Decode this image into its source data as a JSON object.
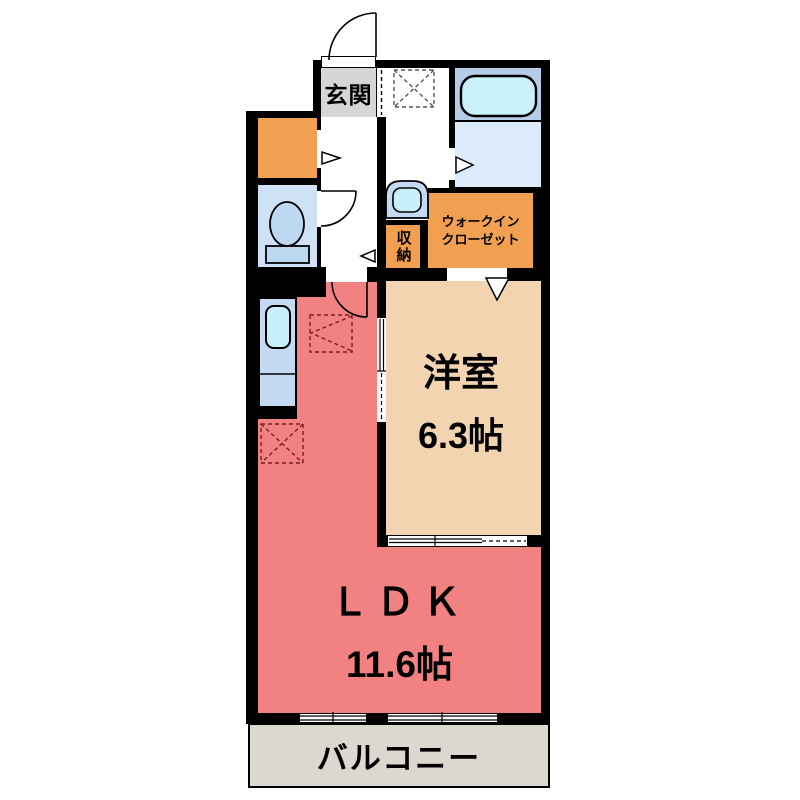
{
  "plan_title": "1LDK apartment floor plan",
  "rooms": {
    "genkan": {
      "label": "玄関"
    },
    "shuno": {
      "label": "収納"
    },
    "wic": {
      "label_line1": "ウォークイン",
      "label_line2": "クローゼット"
    },
    "yoshitsu": {
      "label": "洋室",
      "size": "6.3帖"
    },
    "ldk": {
      "label": "ＬＤＫ",
      "size": "11.6帖"
    },
    "balcony": {
      "label": "バルコニー"
    }
  },
  "colors": {
    "wall": "#000000",
    "ldk_pink": "#f28181",
    "western_room_peach": "#f3d4b0",
    "closet_orange": "#f0a050",
    "entrance_gray": "#d6d6d6",
    "bath_blue": "#b5cde9",
    "bath_floor_blue": "#dcebf9",
    "bathtub_cyan": "#cbf1fa",
    "toilet_room_blue": "#cfe1f4",
    "fixture_blue": "#bdd9f2",
    "sink_cyan": "#c9f0fa",
    "counter_blue": "#c3daf2",
    "balcony_gray": "#dcd8d0"
  }
}
